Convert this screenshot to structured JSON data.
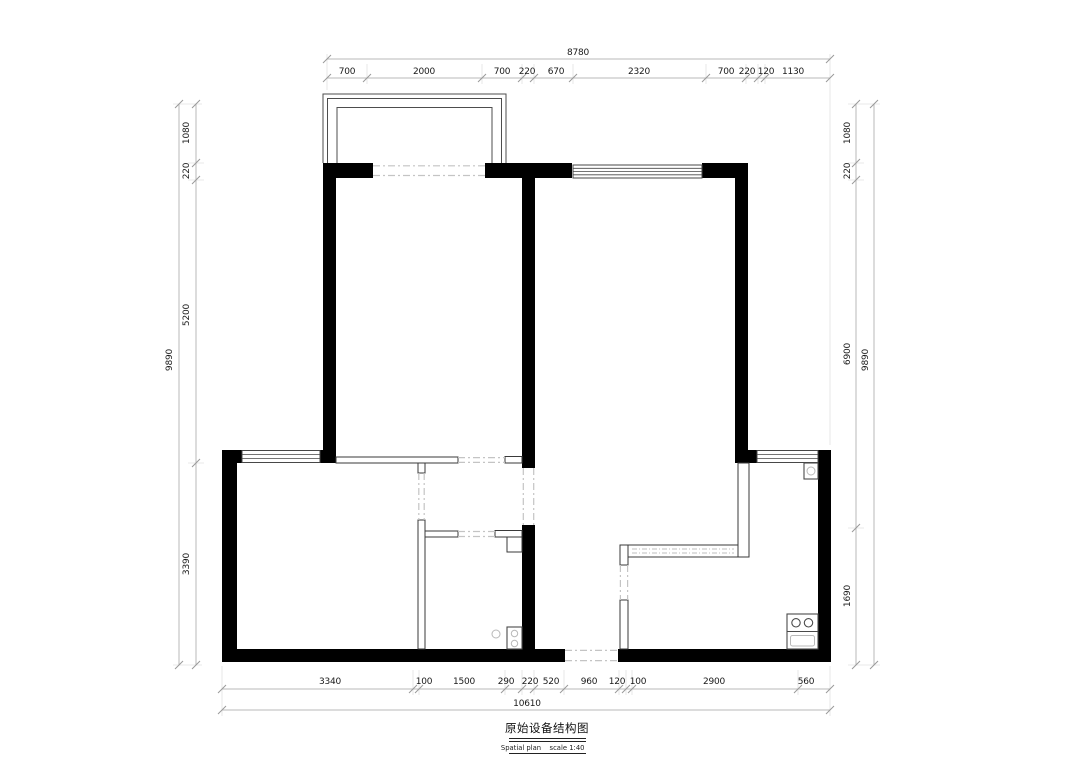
{
  "title_block": {
    "title": "原始设备结构图",
    "subtitle_en": "Spatial plan",
    "subtitle_scale": "scale 1:40"
  },
  "dimensions": {
    "top": {
      "overall": "8780",
      "segments": [
        "700",
        "2000",
        "700",
        "220",
        "670",
        "2320",
        "700",
        "220",
        "120",
        "1130"
      ]
    },
    "bottom": {
      "overall": "10610",
      "segments": [
        "3340",
        "100",
        "1500",
        "290",
        "220",
        "520",
        "960",
        "120",
        "100",
        "2900",
        "560"
      ]
    },
    "left": {
      "overall": "9890",
      "segments": [
        "1080",
        "220",
        "5200",
        "3390"
      ]
    },
    "right": {
      "overall": "9890",
      "segments": [
        "1080",
        "220",
        "6900",
        "1690"
      ]
    }
  },
  "colors": {
    "wall": "#000000",
    "thin_wall_stroke": "#3a3a3a",
    "window_stroke": "#474747",
    "dashed_opening": "#c4c4c4",
    "dimension_line": "#b8b8b8",
    "dimension_text": "#1a1a1a",
    "background": "#ffffff"
  }
}
